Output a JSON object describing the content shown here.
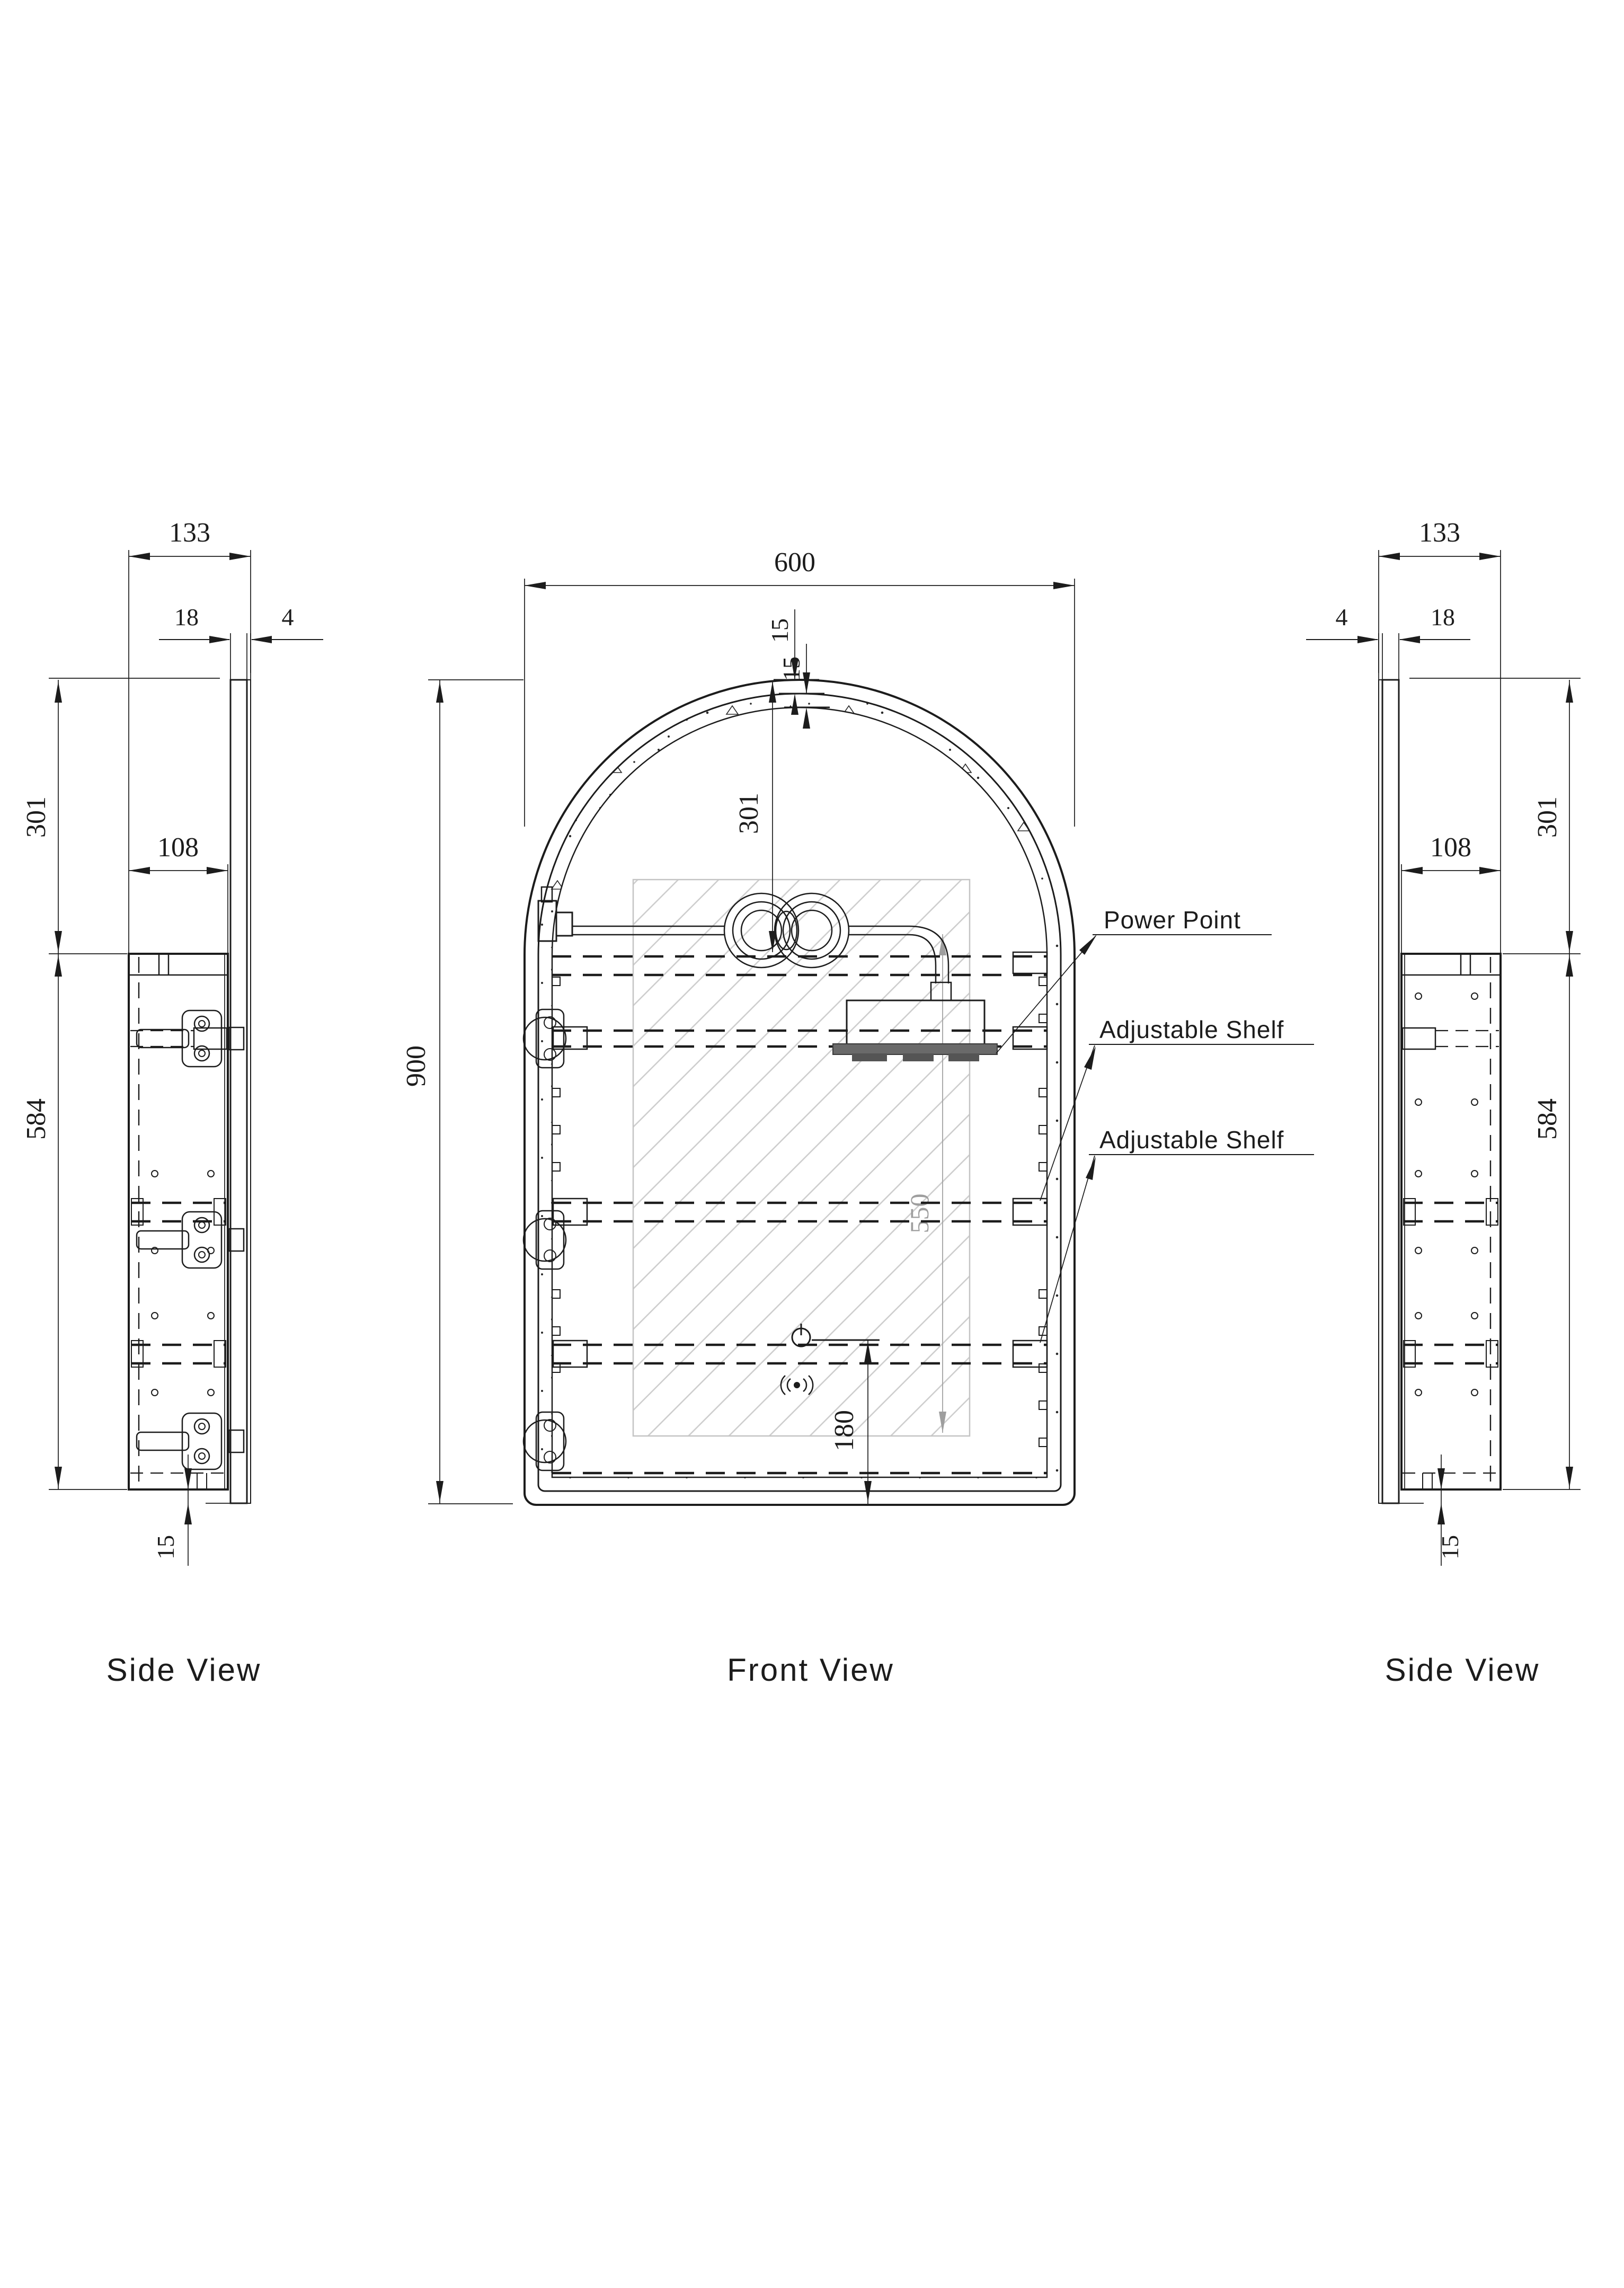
{
  "drawing": {
    "type": "technical-orthographic-drawing",
    "subject": "arched mirror cabinet",
    "colors": {
      "line": "#1c1c1c",
      "hatch_gray": "#cccccc",
      "dim_gray": "#9e9e9e"
    }
  },
  "views": {
    "side_left": {
      "caption": "Side View",
      "dims": {
        "total_depth": "133",
        "door_thickness": "18",
        "mirror_thickness": "4",
        "top_offset": "301",
        "cabinet_depth": "108",
        "cabinet_height": "584",
        "door_overhang": "15"
      }
    },
    "front": {
      "caption": "Front View",
      "dims": {
        "overall_width": "600",
        "arch_frame_outer": "15",
        "arch_frame_inner": "15",
        "top_offset": "301",
        "overall_height": "900",
        "mirror_height": "550",
        "controls_height": "180"
      },
      "callouts": {
        "power_point": "Power Point",
        "adjustable_shelf_upper": "Adjustable Shelf",
        "adjustable_shelf_lower": "Adjustable Shelf"
      }
    },
    "side_right": {
      "caption": "Side View",
      "dims": {
        "total_depth": "133",
        "door_thickness": "18",
        "mirror_thickness": "4",
        "top_offset": "301",
        "cabinet_depth": "108",
        "cabinet_height": "584",
        "door_overhang": "15"
      }
    }
  }
}
